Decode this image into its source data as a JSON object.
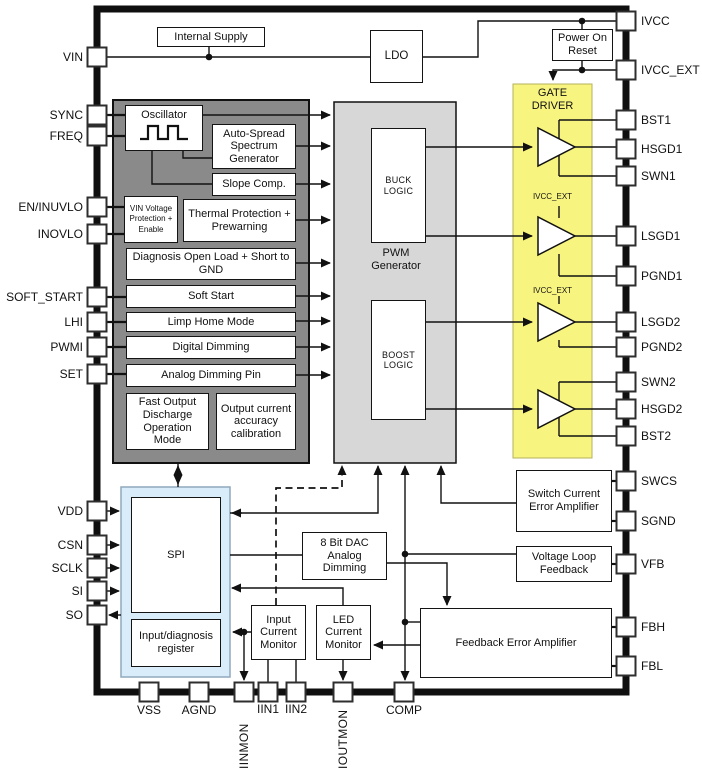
{
  "diagram_type": "IC functional block diagram",
  "pins": {
    "left": [
      "VIN",
      "SYNC",
      "FREQ",
      "EN/INUVLO",
      "INOVLO",
      "SOFT_START",
      "LHI",
      "PWMI",
      "SET",
      "VDD",
      "CSN",
      "SCLK",
      "SI",
      "SO"
    ],
    "right": [
      "IVCC",
      "IVCC_EXT",
      "BST1",
      "HSGD1",
      "SWN1",
      "LSGD1",
      "PGND1",
      "LSGD2",
      "PGND2",
      "SWN2",
      "HSGD2",
      "BST2",
      "SWCS",
      "SGND",
      "VFB",
      "FBH",
      "FBL"
    ],
    "bottom": [
      "VSS",
      "AGND",
      "IINMON",
      "IIN1",
      "IIN2",
      "IOUTMON",
      "COMP"
    ]
  },
  "blocks": {
    "internal_supply": "Internal Supply",
    "ldo": "LDO",
    "power_on_reset": "Power On Reset",
    "gate_driver": "GATE DRIVER",
    "gate_driver_supply": "IVCC_EXT",
    "oscillator": "Oscillator",
    "auto_spread": "Auto-Spread Spectrum Generator",
    "slope_comp": "Slope Comp.",
    "vin_protection": "VIN Voltage Protection + Enable",
    "thermal_protection": "Thermal Protection + Prewarning",
    "diagnosis": "Diagnosis Open Load + Short to GND",
    "soft_start": "Soft Start",
    "limp_home": "Limp Home Mode",
    "digital_dimming": "Digital Dimming",
    "analog_dimming": "Analog Dimming Pin",
    "fast_output_discharge": "Fast Output Discharge Operation Mode",
    "output_current_calibration": "Output current accuracy calibration",
    "pwm_generator": "PWM Generator",
    "buck_logic": "BUCK LOGIC",
    "boost_logic": "BOOST LOGIC",
    "spi": "SPI",
    "input_diagnosis_register": "Input/diagnosis register",
    "dac": "8 Bit DAC Analog Dimming",
    "input_current_monitor": "Input Current Monitor",
    "led_current_monitor": "LED Current Monitor",
    "switch_current_error_amplifier": "Switch Current Error Amplifier",
    "voltage_loop_feedback": "Voltage Loop Feedback",
    "feedback_error_amplifier": "Feedback Error Amplifier"
  },
  "colors": {
    "gate_driver_fill": "#f8f480",
    "control_block_fill": "#8a8a8a",
    "pwm_block_fill": "#d7d7d7",
    "spi_fill": "#d9ecfa",
    "wire": "#111111"
  }
}
